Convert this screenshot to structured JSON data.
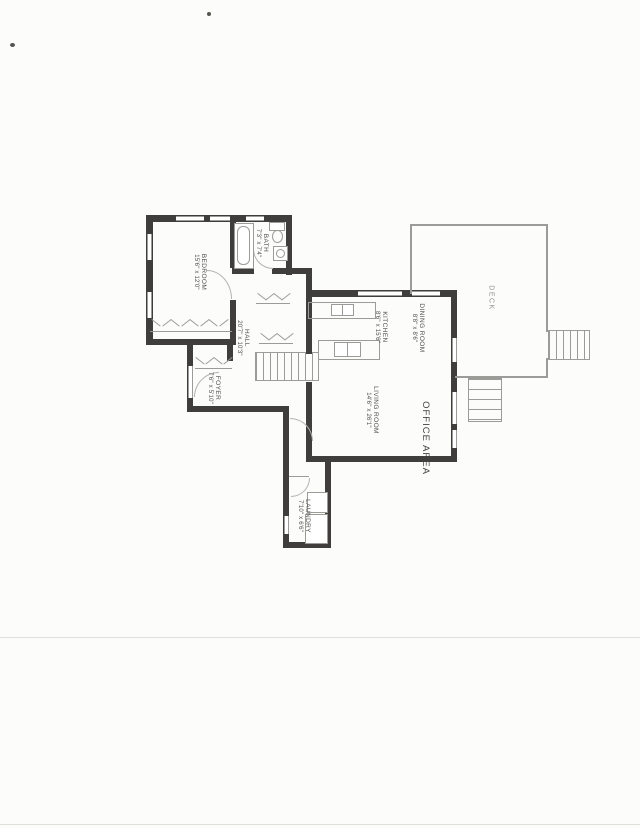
{
  "document": {
    "kind": "scanned-residential-floor-plan"
  },
  "colors": {
    "paper": "#fcfcfa",
    "wall": "#3f3e3c",
    "thin_line": "#9b9b98",
    "label_text": "#4f4f4d",
    "deck_text": "#8f8f8c"
  },
  "rooms": [
    {
      "name": "BEDROOM",
      "dims": "15'6\" x 12'0\""
    },
    {
      "name": "BATH",
      "dims": "7'3\" x 7'4\""
    },
    {
      "name": "HALL",
      "dims": "20'7\" x 10'3\""
    },
    {
      "name": "FOYER",
      "dims": "7'6\" x 5'10\""
    },
    {
      "name": "KITCHEN",
      "dims": "8'6\" x 15'6\""
    },
    {
      "name": "DINING ROOM",
      "dims": "8'8\" x 8'6\""
    },
    {
      "name": "LIVING ROOM",
      "dims": "14'6\" x 26'1\""
    },
    {
      "name": "OFFICE AREA",
      "dims": ""
    },
    {
      "name": "LAUNDRY",
      "dims": "7'10\" x 6'6\""
    },
    {
      "name": "DECK",
      "dims": ""
    }
  ]
}
